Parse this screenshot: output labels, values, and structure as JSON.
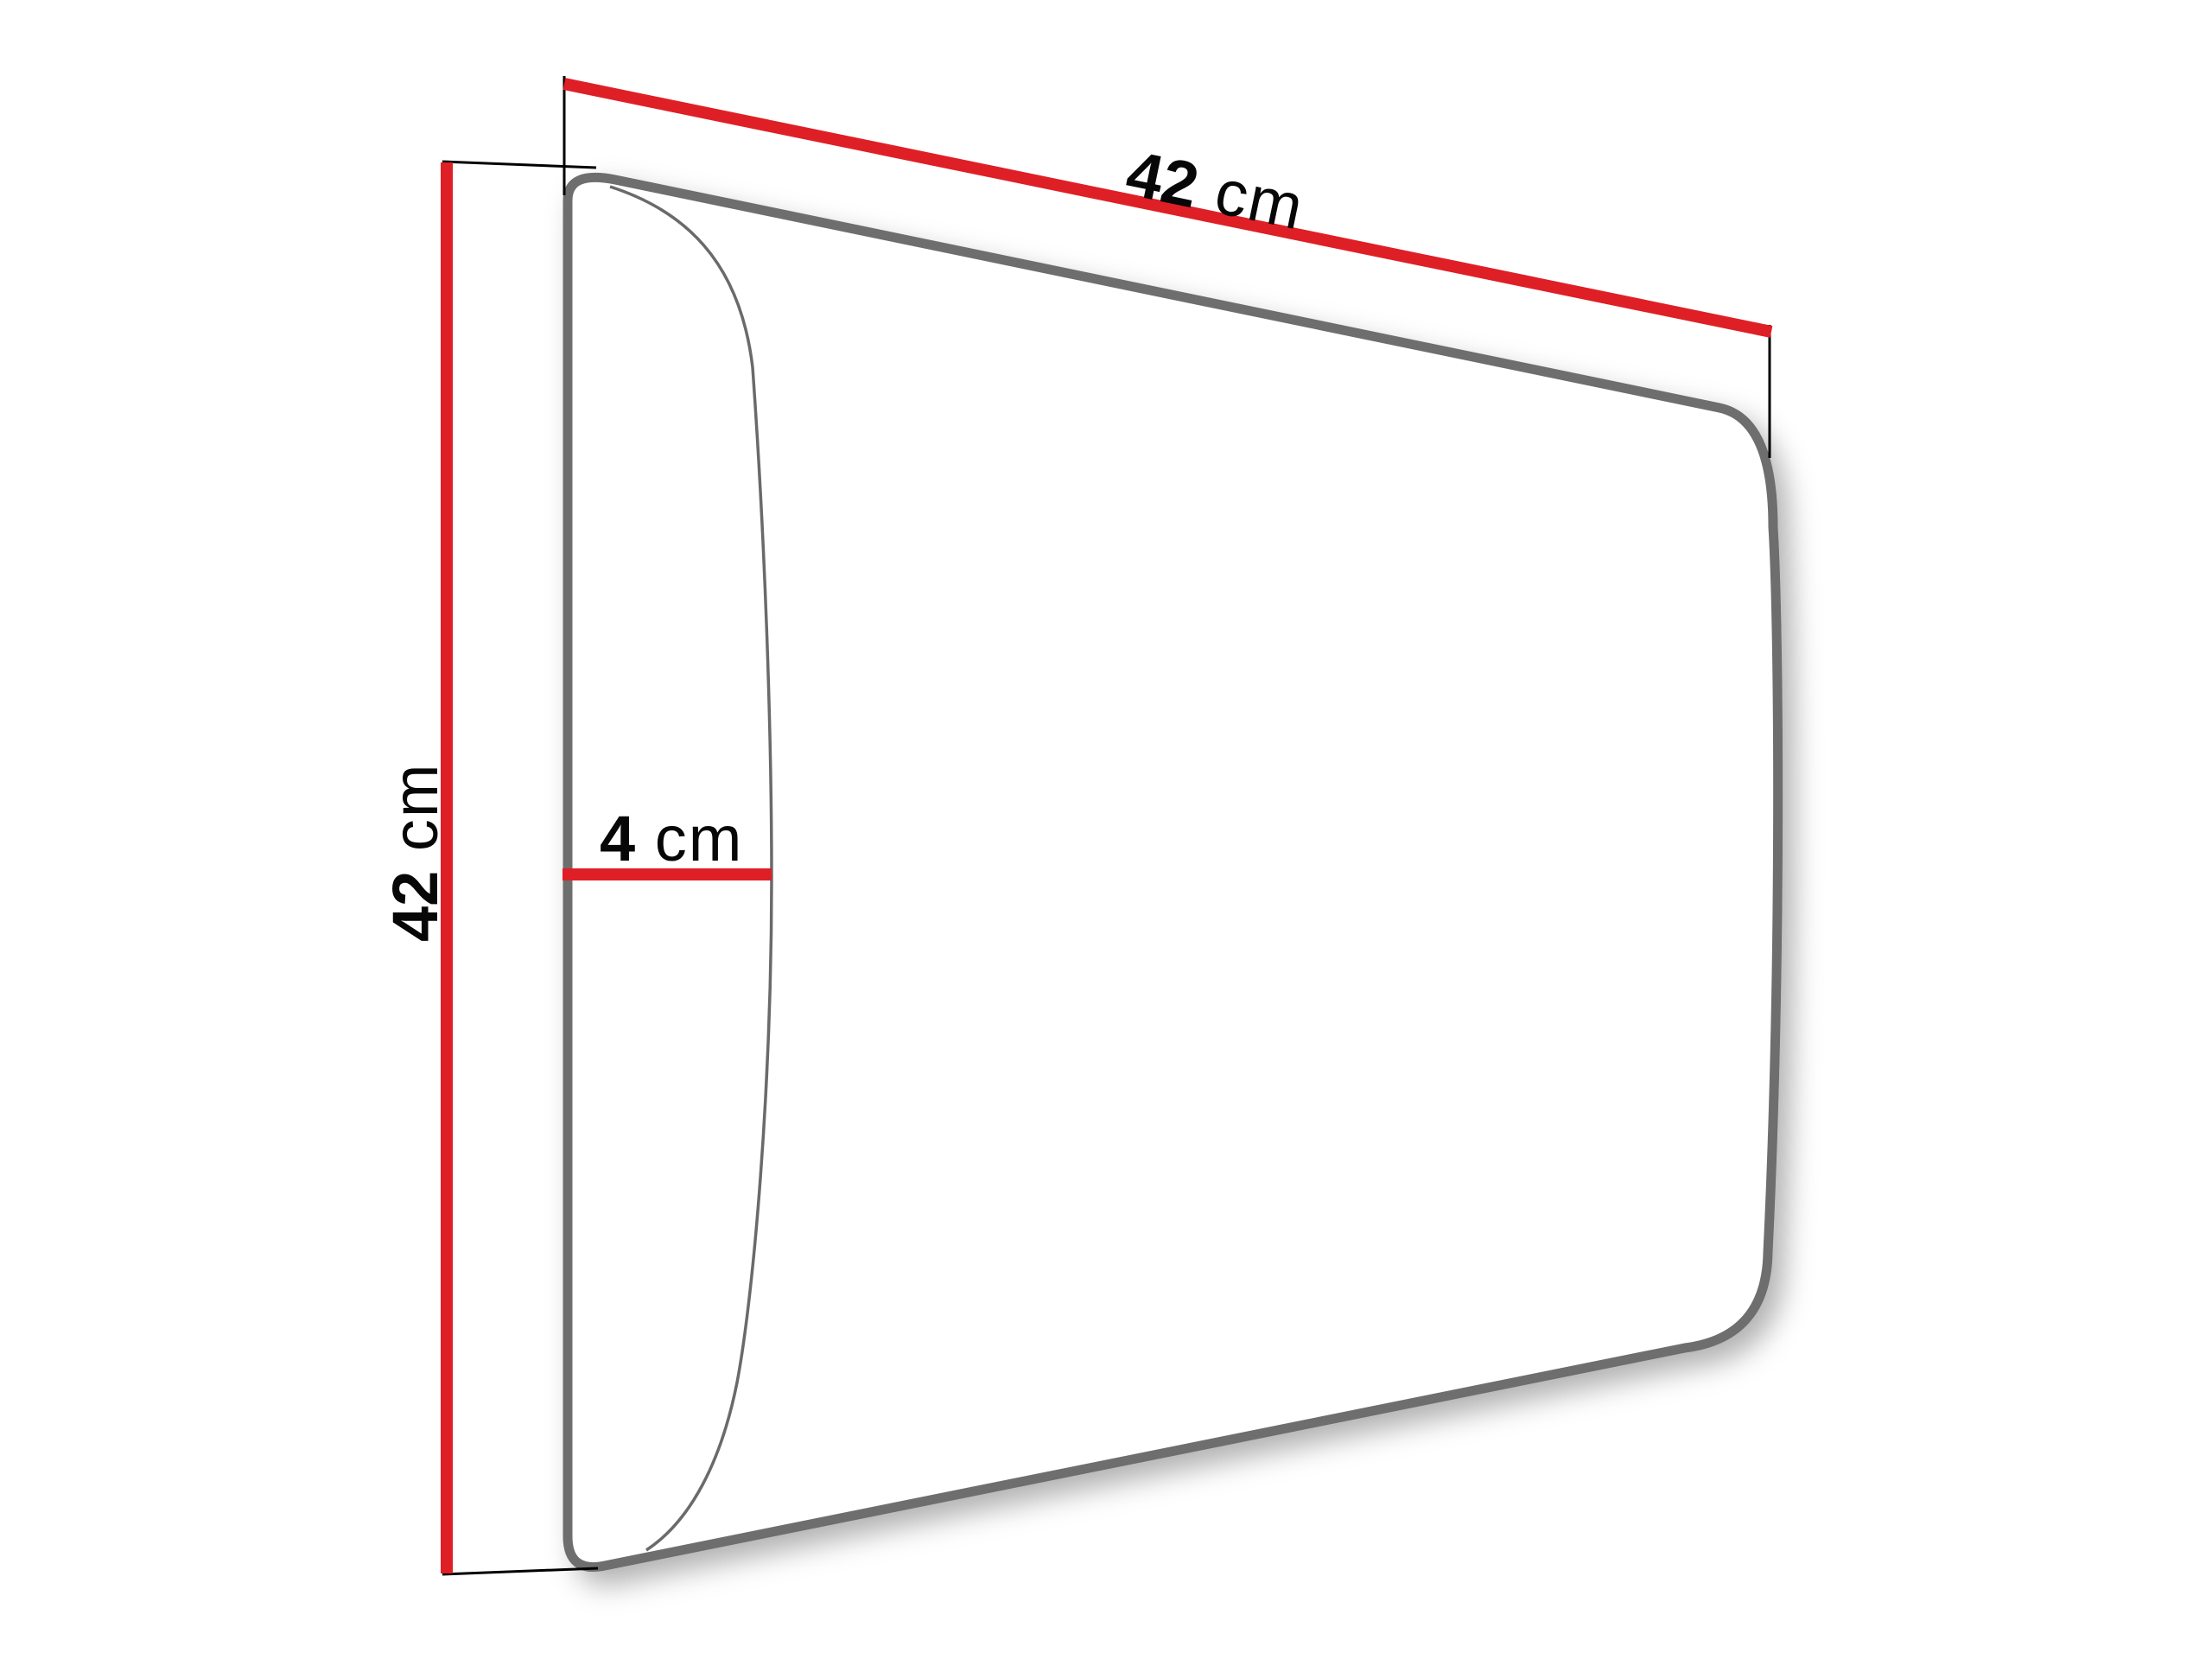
{
  "dimensions": {
    "width": {
      "value": "42",
      "unit": "cm"
    },
    "height": {
      "value": "42",
      "unit": "cm"
    },
    "depth": {
      "value": "4",
      "unit": "cm"
    }
  },
  "colors": {
    "dimension_line": "#df1f26",
    "outline": "#6e6e6e",
    "front_edge": "#6a6a6a",
    "extension_line": "#000000",
    "label_text": "#070707",
    "background": "#ffffff"
  }
}
